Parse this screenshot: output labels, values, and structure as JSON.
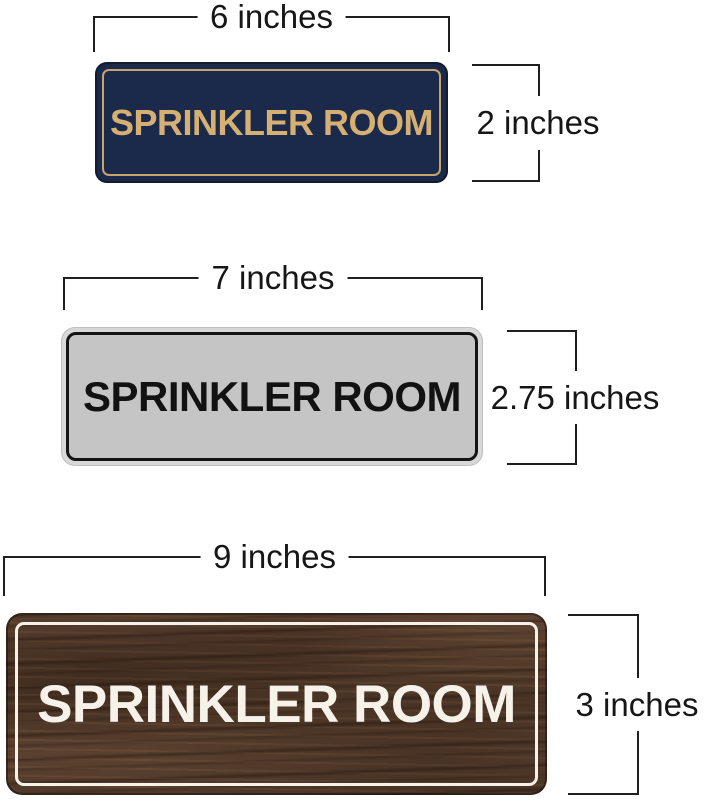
{
  "annotation_color": "#1f1f1f",
  "signs": [
    {
      "style": "navy-gold",
      "text": "SPRINKLER ROOM",
      "width_label": "6 inches",
      "height_label": "2 inches",
      "colors": {
        "background": "#1b2a4b",
        "border": "#c7a566",
        "text": "#d6af72"
      }
    },
    {
      "style": "silver-black",
      "text": "SPRINKLER ROOM",
      "width_label": "7 inches",
      "height_label": "2.75 inches",
      "colors": {
        "rim": "#d8d8d8",
        "background": "#c5c5c5",
        "border": "#141414",
        "text": "#121212"
      }
    },
    {
      "style": "walnut-wood",
      "text": "SPRINKLER ROOM",
      "width_label": "9 inches",
      "height_label": "3 inches",
      "colors": {
        "background": "#523a2b",
        "border": "#f6f2ea",
        "text": "#f6f2ea"
      }
    }
  ]
}
